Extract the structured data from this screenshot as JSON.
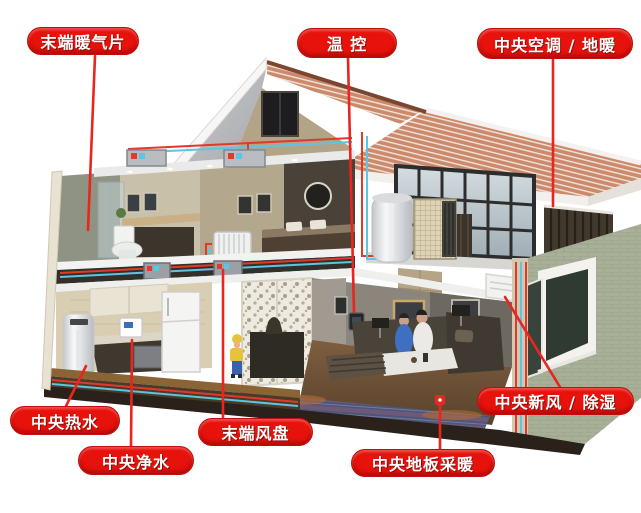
{
  "labels": [
    {
      "id": "terminal-radiator",
      "text": "末端暖气片"
    },
    {
      "id": "thermostat",
      "text": "温 控"
    },
    {
      "id": "central-ac-floor-heating",
      "text": "中央空调 / 地暖"
    },
    {
      "id": "central-hot-water",
      "text": "中央热水"
    },
    {
      "id": "central-water-purification",
      "text": "中央净水"
    },
    {
      "id": "terminal-fan-coil",
      "text": "末端风盘"
    },
    {
      "id": "central-floor-heating",
      "text": "中央地板采暖"
    },
    {
      "id": "central-fresh-air-dehumidification",
      "text": "中央新风 / 除湿"
    }
  ],
  "colors": {
    "label_bg": "#e8120c",
    "label_text": "#ffffff",
    "leader_line": "#e8251f",
    "pipe_hot": "#e03a2a",
    "pipe_cold": "#5fc4e0",
    "roof_tile": "#cc8a6c",
    "roof_underside": "#b9babe",
    "exterior_wall": "#a9b098",
    "background": "#ffffff"
  },
  "scene": {
    "type": "cutaway-house-hvac-illustration",
    "rooms": [
      "attic",
      "bathroom",
      "bedroom",
      "kitchen",
      "living-room",
      "sun-room",
      "terrace"
    ],
    "equipment": [
      "heat-pump-outdoor-unit",
      "hot-water-tank",
      "bedroom-radiator",
      "ceiling-duct-units",
      "fan-coil-units",
      "wall-thermostat",
      "water-purifier",
      "fresh-air-corner-duct",
      "floor-heating-coils",
      "water-heater-tank"
    ]
  }
}
